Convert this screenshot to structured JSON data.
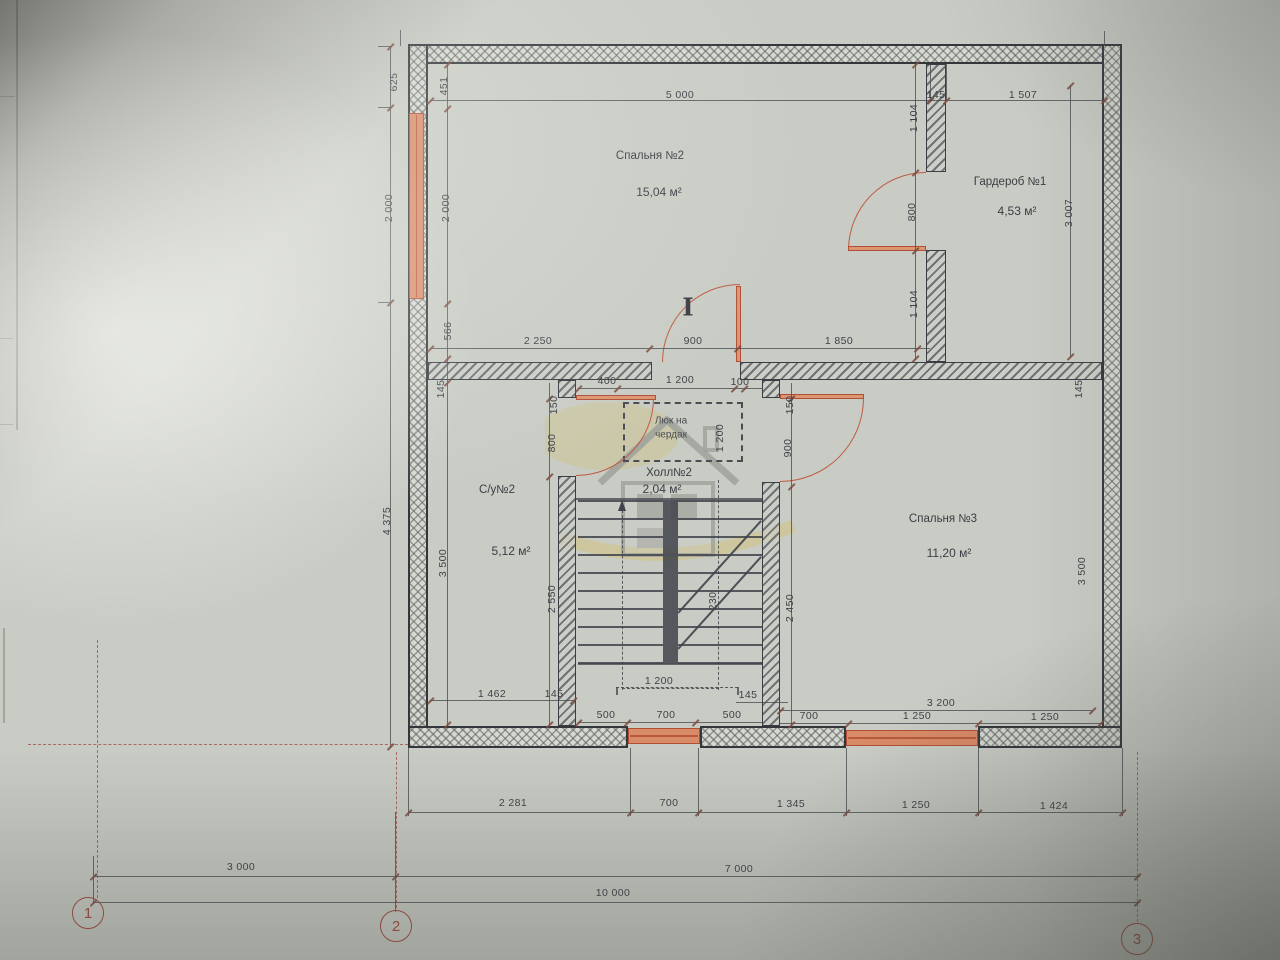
{
  "rooms": [
    {
      "name": "Спальня №2",
      "area": "15,04 м²",
      "name_pos": [
        650,
        156
      ],
      "area_pos": [
        659,
        192
      ]
    },
    {
      "name": "Гардероб №1",
      "area": "4,53 м²",
      "name_pos": [
        1010,
        182
      ],
      "area_pos": [
        1017,
        211
      ]
    },
    {
      "name": "С/у№2",
      "area": "5,12 м²",
      "name_pos": [
        497,
        490
      ],
      "area_pos": [
        511,
        551
      ]
    },
    {
      "name": "Холл№2",
      "area": "2,04 м²",
      "name_pos": [
        669,
        473
      ],
      "area_pos": [
        662,
        489
      ]
    },
    {
      "name": "Спальня №3",
      "area": "11,20 м²",
      "name_pos": [
        943,
        519
      ],
      "area_pos": [
        949,
        553
      ]
    }
  ],
  "attic_hatch": {
    "line1": "Люк на",
    "line2": "чердак",
    "x": 671,
    "y": 428
  },
  "door_symbol": {
    "glyph": "I",
    "x": 688,
    "y": 307
  },
  "dims": [
    {
      "t": "5 000",
      "x": 680,
      "y": 95
    },
    {
      "t": "145",
      "x": 936,
      "y": 95
    },
    {
      "t": "1 507",
      "x": 1023,
      "y": 95
    },
    {
      "t": "2 250",
      "x": 538,
      "y": 341
    },
    {
      "t": "900",
      "x": 693,
      "y": 341
    },
    {
      "t": "1 850",
      "x": 839,
      "y": 341
    },
    {
      "t": "400",
      "x": 607,
      "y": 381
    },
    {
      "t": "1 200",
      "x": 680,
      "y": 380
    },
    {
      "t": "100",
      "x": 740,
      "y": 382
    },
    {
      "t": "1 462",
      "x": 492,
      "y": 694
    },
    {
      "t": "145",
      "x": 554,
      "y": 694
    },
    {
      "t": "1 200",
      "x": 659,
      "y": 681
    },
    {
      "t": "145",
      "x": 748,
      "y": 695
    },
    {
      "t": "3 200",
      "x": 941,
      "y": 703
    },
    {
      "t": "500",
      "x": 606,
      "y": 715
    },
    {
      "t": "700",
      "x": 666,
      "y": 715
    },
    {
      "t": "500",
      "x": 732,
      "y": 715
    },
    {
      "t": "700",
      "x": 809,
      "y": 716
    },
    {
      "t": "1 250",
      "x": 917,
      "y": 716
    },
    {
      "t": "1 250",
      "x": 1045,
      "y": 717
    },
    {
      "t": "2 281",
      "x": 513,
      "y": 803
    },
    {
      "t": "700",
      "x": 669,
      "y": 803
    },
    {
      "t": "1 345",
      "x": 791,
      "y": 804
    },
    {
      "t": "1 250",
      "x": 916,
      "y": 805
    },
    {
      "t": "1 424",
      "x": 1054,
      "y": 806
    },
    {
      "t": "3 000",
      "x": 241,
      "y": 867
    },
    {
      "t": "7 000",
      "x": 739,
      "y": 869
    },
    {
      "t": "10 000",
      "x": 613,
      "y": 893
    },
    {
      "t": "625",
      "x": 394,
      "y": 82,
      "v": true
    },
    {
      "t": "451",
      "x": 444,
      "y": 86,
      "v": true
    },
    {
      "t": "2 000",
      "x": 389,
      "y": 208,
      "v": true
    },
    {
      "t": "2 000",
      "x": 446,
      "y": 208,
      "v": true
    },
    {
      "t": "566",
      "x": 448,
      "y": 331,
      "v": true
    },
    {
      "t": "145",
      "x": 441,
      "y": 389,
      "v": true
    },
    {
      "t": "4 375",
      "x": 387,
      "y": 521,
      "v": true
    },
    {
      "t": "3 500",
      "x": 443,
      "y": 563,
      "v": true
    },
    {
      "t": "1 104",
      "x": 914,
      "y": 118,
      "v": true
    },
    {
      "t": "800",
      "x": 912,
      "y": 212,
      "v": true
    },
    {
      "t": "1 104",
      "x": 914,
      "y": 304,
      "v": true
    },
    {
      "t": "3 007",
      "x": 1069,
      "y": 213,
      "v": true
    },
    {
      "t": "150",
      "x": 554,
      "y": 405,
      "v": true
    },
    {
      "t": "800",
      "x": 552,
      "y": 443,
      "v": true
    },
    {
      "t": "1 200",
      "x": 720,
      "y": 438,
      "v": true
    },
    {
      "t": "150",
      "x": 790,
      "y": 405,
      "v": true
    },
    {
      "t": "900",
      "x": 788,
      "y": 448,
      "v": true
    },
    {
      "t": "2 550",
      "x": 552,
      "y": 599,
      "v": true
    },
    {
      "t": "2 450",
      "x": 790,
      "y": 608,
      "v": true
    },
    {
      "t": "230",
      "x": 713,
      "y": 601,
      "v": true
    },
    {
      "t": "145",
      "x": 1079,
      "y": 389,
      "v": true
    },
    {
      "t": "3 500",
      "x": 1082,
      "y": 571,
      "v": true
    }
  ],
  "axes": [
    {
      "label": "1",
      "x": 88,
      "y": 913
    },
    {
      "label": "2",
      "x": 396,
      "y": 926
    },
    {
      "label": "3",
      "x": 1137,
      "y": 939
    }
  ],
  "colors": {
    "accent_red": "#c05a42",
    "window_fill": "#d98a66",
    "axis_red": "#a14a3e",
    "line": "#41454b",
    "paper": "#c8ccc4"
  }
}
